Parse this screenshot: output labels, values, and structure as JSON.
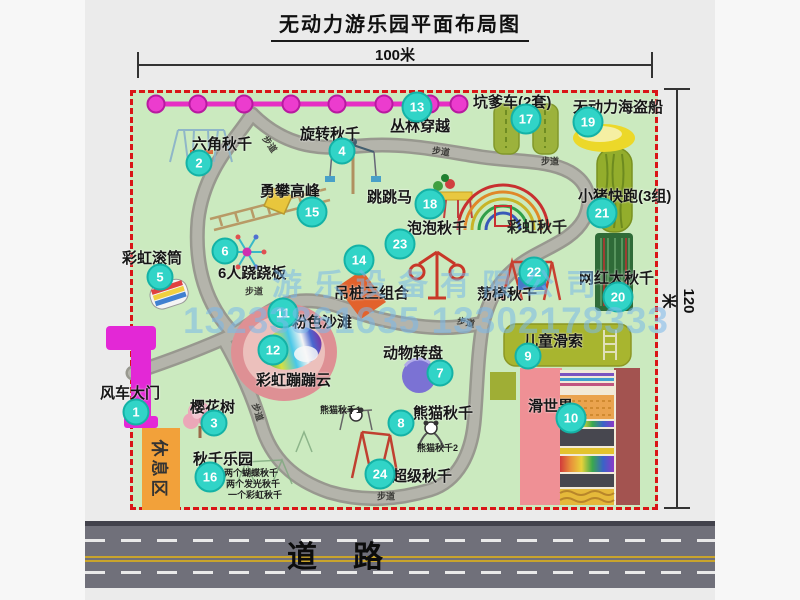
{
  "title": "无动力游乐园平面布局图",
  "dimensions": {
    "width_label": "100米",
    "height_label": "120米"
  },
  "watermark": {
    "company": "游乐设备有限公司",
    "phone": "13233861635 13302178333"
  },
  "road": {
    "label": "道路"
  },
  "rest_area": {
    "label": "休息区"
  },
  "map": {
    "path_label": "步道",
    "path_label_positions": [
      {
        "x": 270,
        "y": 144,
        "rot": 55
      },
      {
        "x": 441,
        "y": 151,
        "rot": 8
      },
      {
        "x": 550,
        "y": 161,
        "rot": 0
      },
      {
        "x": 254,
        "y": 291,
        "rot": 0
      },
      {
        "x": 466,
        "y": 322,
        "rot": 12
      },
      {
        "x": 258,
        "y": 412,
        "rot": 72
      },
      {
        "x": 386,
        "y": 496,
        "rot": 0
      }
    ],
    "items": [
      {
        "num": "1",
        "label": "风车大门",
        "mx": 136,
        "my": 412,
        "lx": 100,
        "ly": 382
      },
      {
        "num": "2",
        "label": "六角秋千",
        "mx": 199,
        "my": 163,
        "lx": 192,
        "ly": 133
      },
      {
        "num": "3",
        "label": "樱花树",
        "mx": 214,
        "my": 423,
        "lx": 190,
        "ly": 396
      },
      {
        "num": "4",
        "label": "旋转秋千",
        "mx": 342,
        "my": 151,
        "lx": 300,
        "ly": 123
      },
      {
        "num": "5",
        "label": "彩虹滚筒",
        "mx": 160,
        "my": 277,
        "lx": 122,
        "ly": 247
      },
      {
        "num": "6",
        "label": "6人跷跷板",
        "mx": 225,
        "my": 251,
        "lx": 218,
        "ly": 262
      },
      {
        "num": "7",
        "label": "动物转盘",
        "mx": 440,
        "my": 373,
        "lx": 383,
        "ly": 342
      },
      {
        "num": "8",
        "label": "熊猫秋千",
        "mx": 401,
        "my": 423,
        "lx": 413,
        "ly": 402
      },
      {
        "num": "9",
        "label": "儿童滑索",
        "mx": 528,
        "my": 356,
        "lx": 523,
        "ly": 330
      },
      {
        "num": "10",
        "label": "滑世界",
        "mx": 571,
        "my": 418,
        "lx": 528,
        "ly": 395
      },
      {
        "num": "11",
        "label": "粉色沙滩",
        "mx": 283,
        "my": 313,
        "lx": 292,
        "ly": 311
      },
      {
        "num": "12",
        "label": "彩虹蹦蹦云",
        "mx": 273,
        "my": 350,
        "lx": 256,
        "ly": 369
      },
      {
        "num": "13",
        "label": "丛林穿越",
        "mx": 417,
        "my": 107,
        "lx": 390,
        "ly": 115
      },
      {
        "num": "14",
        "label": "吊桩三组合",
        "mx": 359,
        "my": 260,
        "lx": 334,
        "ly": 282
      },
      {
        "num": "15",
        "label": "勇攀高峰",
        "mx": 312,
        "my": 212,
        "lx": 260,
        "ly": 180
      },
      {
        "num": "16",
        "label": "秋千乐园",
        "mx": 210,
        "my": 477,
        "lx": 193,
        "ly": 448
      },
      {
        "num": "17",
        "label": "坑爹车(2套)",
        "mx": 526,
        "my": 119,
        "lx": 473,
        "ly": 91
      },
      {
        "num": "18",
        "label": "跳跳马",
        "mx": 430,
        "my": 204,
        "lx": 367,
        "ly": 186
      },
      {
        "num": "19",
        "label": "无动力海盗船",
        "mx": 588,
        "my": 122,
        "lx": 573,
        "ly": 96
      },
      {
        "num": "20",
        "label": "网红大秋千",
        "mx": 618,
        "my": 297,
        "lx": 579,
        "ly": 267
      },
      {
        "num": "21",
        "label": "小猪快跑(3组)",
        "mx": 602,
        "my": 213,
        "lx": 578,
        "ly": 185
      },
      {
        "num": "22",
        "label": "荡椅秋千",
        "mx": 534,
        "my": 272,
        "lx": 477,
        "ly": 283
      },
      {
        "num": "23",
        "label": "泡泡秋千",
        "mx": 400,
        "my": 244,
        "lx": 407,
        "ly": 217
      },
      {
        "num": "24",
        "label": "超级秋千",
        "mx": 380,
        "my": 474,
        "lx": 392,
        "ly": 465
      }
    ],
    "extra_labels": [
      {
        "text": "彩虹秋千",
        "x": 507,
        "y": 216,
        "size": 15
      },
      {
        "text": "熊猫秋千1",
        "x": 320,
        "y": 403,
        "size": 9
      },
      {
        "text": "熊猫秋千2",
        "x": 417,
        "y": 441,
        "size": 9
      },
      {
        "text": "两个蝴蝶秋千",
        "x": 224,
        "y": 466,
        "size": 9
      },
      {
        "text": "两个发光秋千",
        "x": 226,
        "y": 477,
        "size": 9
      },
      {
        "text": "一个彩虹秋千",
        "x": 228,
        "y": 488,
        "size": 9
      }
    ]
  }
}
